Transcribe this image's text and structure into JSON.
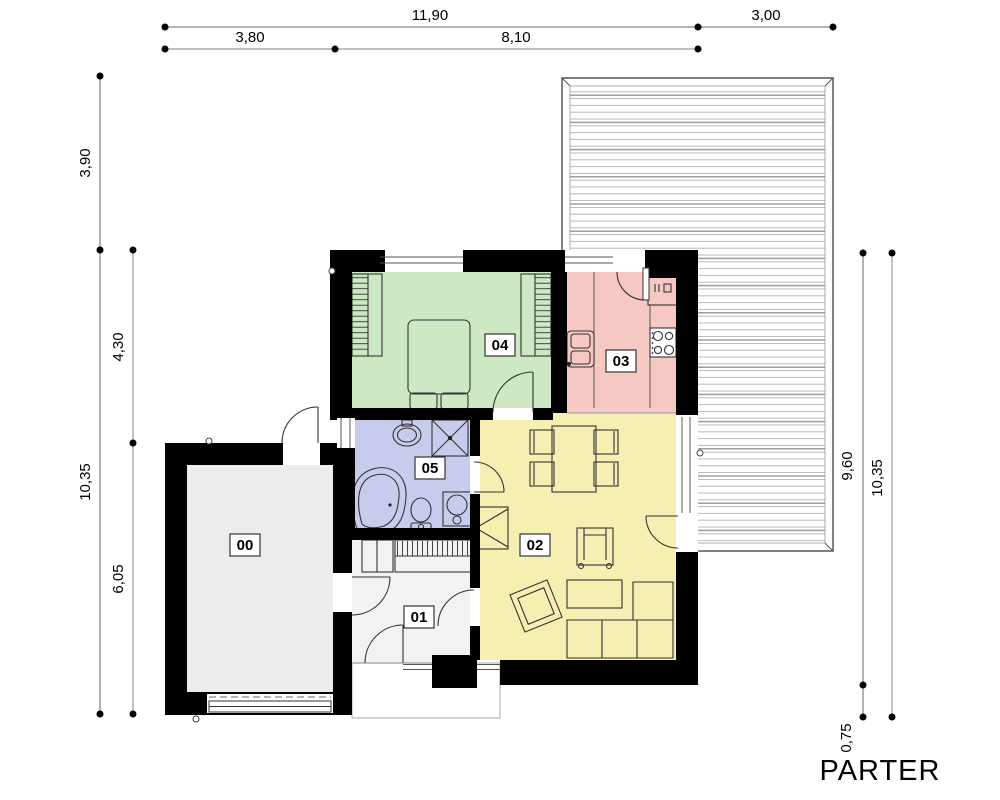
{
  "title": "PARTER",
  "dims": {
    "top": [
      "11,90",
      "3,00",
      "3,80",
      "8,10"
    ],
    "left": [
      "3,90",
      "10,35",
      "4,30",
      "6,05"
    ],
    "right": [
      "9,60",
      "10,35",
      "0,75"
    ]
  },
  "rooms": {
    "r00": {
      "label": "00",
      "color": "#ececec"
    },
    "r01": {
      "label": "01",
      "color": "#f2f2f2"
    },
    "r02": {
      "label": "02",
      "color": "#f6efb2"
    },
    "r03": {
      "label": "03",
      "color": "#f5c8c4"
    },
    "r04": {
      "label": "04",
      "color": "#cde9c3"
    },
    "r05": {
      "label": "05",
      "color": "#c7cced"
    }
  },
  "colors": {
    "wall": "#000000",
    "deck_line": "#b8b8b8",
    "deck_line_dark": "#8f8f8f",
    "dim_line": "#9a9a9a",
    "porch": "#ffffff"
  }
}
